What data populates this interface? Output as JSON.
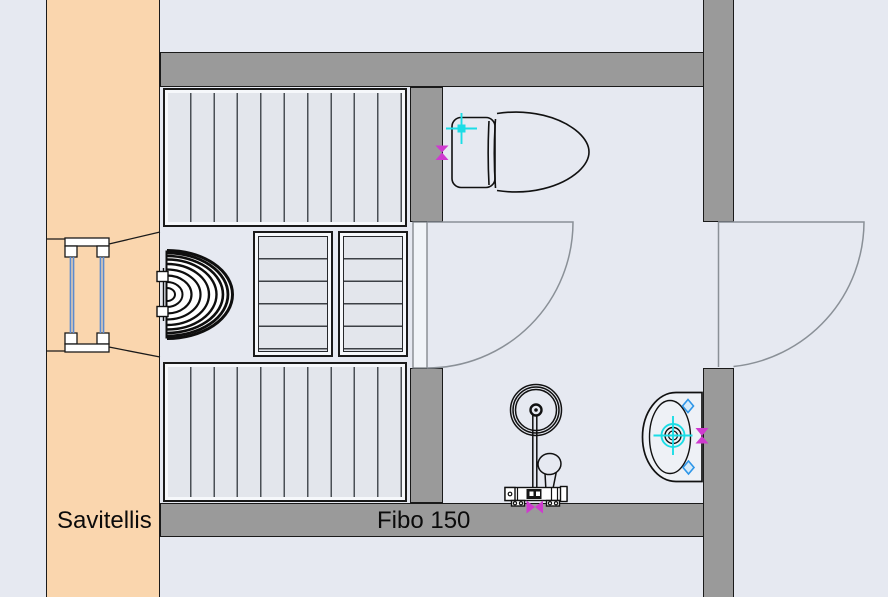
{
  "labels": {
    "left_wall_material": "Savitellis",
    "bottom_wall_material": "Fibo 150"
  },
  "colors": {
    "background": "#E6E9F1",
    "wall_fill": "#9A9A9A",
    "exterior_wall_fill": "#FAD6AE",
    "line": "#1a1a1a",
    "door_swing": "#8A9097",
    "window_glass": "#5B8BD0",
    "snap_cyan": "#1BDDE6",
    "snap_blue": "#2E96E8",
    "snap_magenta": "#CF3ACF"
  },
  "fixtures": [
    {
      "name": "toilet"
    },
    {
      "name": "washbasin"
    },
    {
      "name": "shower-set"
    },
    {
      "name": "sauna-heater"
    },
    {
      "name": "sauna-bench-upper"
    },
    {
      "name": "sauna-bench-lower"
    },
    {
      "name": "slatted-cabinet-1"
    },
    {
      "name": "slatted-cabinet-2"
    },
    {
      "name": "window"
    },
    {
      "name": "door-sauna"
    },
    {
      "name": "door-entry"
    }
  ]
}
